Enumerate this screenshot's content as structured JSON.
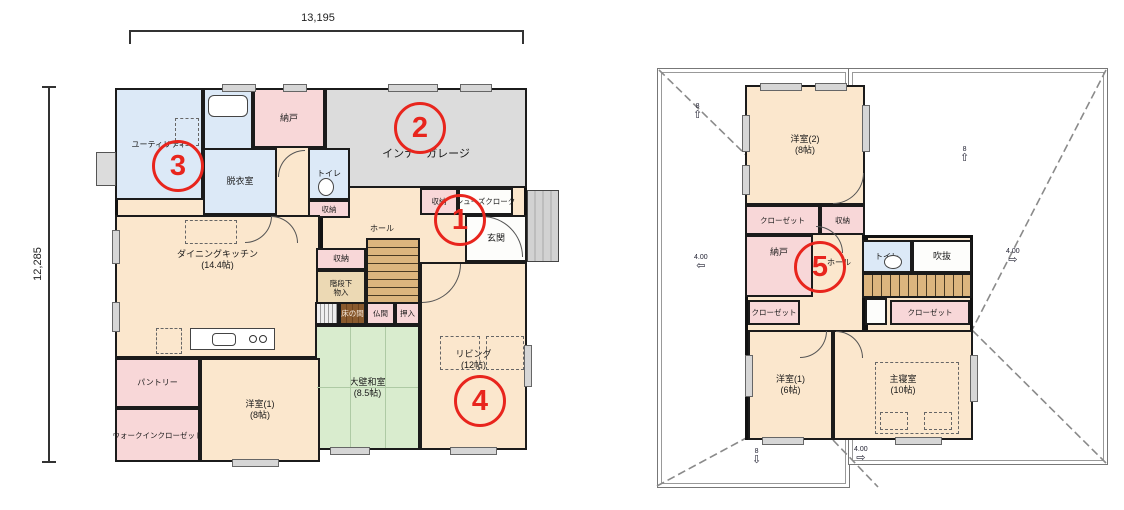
{
  "dimensions": {
    "top": "13,195",
    "left": "12,285"
  },
  "markers": {
    "m1": "1",
    "m2": "2",
    "m3": "3",
    "m4": "4",
    "m5": "5"
  },
  "icons": {
    "arrow_up": "⇧",
    "arrow_down": "⇩",
    "arrow_left": "⇦",
    "arrow_right": "⇨"
  },
  "floor1": {
    "utility": "ユーティリティ",
    "bath": "UB",
    "nando": "納戸",
    "garage": "インナーガレージ",
    "dressing": "脱衣室",
    "toilet": "トイレ",
    "toilet_storage": "収納",
    "entry_storage": "収納",
    "shoe_cloak": "シューズクローク",
    "genkan": "玄関",
    "hall": "ホール",
    "dk_name": "ダイニングキッチン",
    "dk_size": "(14.4帖)",
    "storage_mid": "収納",
    "stair_storage_1": "階段下",
    "stair_storage_2": "物入",
    "tokonoma": "床の間",
    "butsuma": "仏間",
    "oshiire": "押入",
    "washitsu_name": "大壁和室",
    "washitsu_size": "(8.5帖)",
    "living_name": "リビング",
    "living_size": "(12帖)",
    "pantry": "パントリー",
    "yoshitsu_name": "洋室(1)",
    "yoshitsu_size": "(8帖)",
    "wic": "ウォークインクローゼット"
  },
  "floor2": {
    "yoshitsu2_name": "洋室(2)",
    "yoshitsu2_size": "(8帖)",
    "closet_top": "クローゼット",
    "storage_top": "収納",
    "nando": "納戸",
    "hall": "ホール",
    "toilet": "トイレ",
    "fukinuke": "吹抜",
    "closet_left": "クローゼット",
    "closet_right": "クローゼット",
    "yoshitsu1_name": "洋室(1)",
    "yoshitsu1_size": "(6帖)",
    "master_name": "主寝室",
    "master_size": "(10帖)"
  },
  "roof": {
    "pitch_8": "8",
    "pitch_4": "4.00"
  },
  "colors": {
    "accent_red": "#e8251d",
    "wall": "#1b1b1b",
    "room_cream": "#fbe7cd",
    "room_pink": "#f8d7d8",
    "room_blue": "#dce9f7",
    "garage_gray": "#dcdcdc",
    "tatami_green": "#d9ecce"
  }
}
